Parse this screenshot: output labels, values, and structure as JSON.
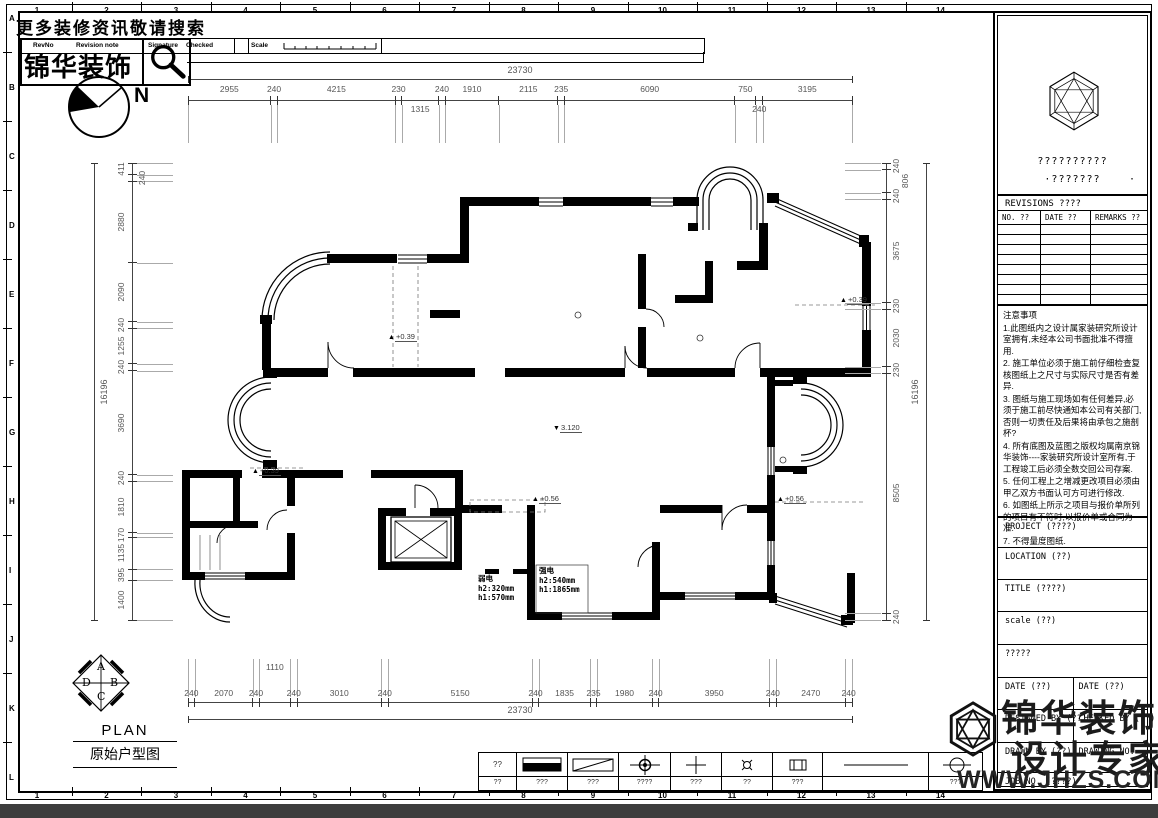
{
  "frame": {
    "grid_columns": [
      "1",
      "2",
      "3",
      "4",
      "5",
      "6",
      "7",
      "8",
      "9",
      "10",
      "11",
      "12",
      "13",
      "14"
    ],
    "grid_rows": [
      "A",
      "B",
      "C",
      "D",
      "E",
      "F",
      "G",
      "H",
      "I",
      "J",
      "K",
      "L"
    ]
  },
  "banner": {
    "search_text": "更多装修资讯敬请搜索",
    "logo_text": "锦华装饰"
  },
  "header_strip": {
    "rev_no": "RevNo",
    "revision_note": "Revision note",
    "signature": "Signature",
    "checked": "Checked",
    "scale": "Scale"
  },
  "compass": {
    "north": "N"
  },
  "dimensions": {
    "top": {
      "overall": "23730",
      "segments": [
        {
          "v": "2955"
        },
        {
          "v": "240"
        },
        {
          "v": "4215"
        },
        {
          "v": "230"
        },
        {
          "v": "1315",
          "row": 2
        },
        {
          "v": "240"
        },
        {
          "v": "1910"
        },
        {
          "v": "2115"
        },
        {
          "v": "235"
        },
        {
          "v": "6090"
        },
        {
          "v": "750"
        },
        {
          "v": "240",
          "row": 2
        },
        {
          "v": "3195"
        }
      ]
    },
    "bottom": {
      "overall": "23730",
      "segments": [
        {
          "v": "240"
        },
        {
          "v": "2070"
        },
        {
          "v": "240"
        },
        {
          "v": "1110",
          "row": 2
        },
        {
          "v": "240"
        },
        {
          "v": "3010"
        },
        {
          "v": "240"
        },
        {
          "v": "5150"
        },
        {
          "v": "240"
        },
        {
          "v": "1835"
        },
        {
          "v": "235"
        },
        {
          "v": "1980"
        },
        {
          "v": "240"
        },
        {
          "v": "3950"
        },
        {
          "v": "240"
        },
        {
          "v": "2470"
        },
        {
          "v": "240"
        }
      ]
    },
    "left": {
      "overall": "16196",
      "segments": [
        {
          "v": "411"
        },
        {
          "v": "240",
          "row": 2
        },
        {
          "v": "2880"
        },
        {
          "v": "2090"
        },
        {
          "v": "240"
        },
        {
          "v": "1255"
        },
        {
          "v": "240"
        },
        {
          "v": "3690"
        },
        {
          "v": "240"
        },
        {
          "v": "1810"
        },
        {
          "v": "170"
        },
        {
          "v": "1135"
        },
        {
          "v": "395"
        },
        {
          "v": "1400"
        }
      ]
    },
    "right": {
      "overall": "16196",
      "segments": [
        {
          "v": "240"
        },
        {
          "v": "806",
          "row": 2
        },
        {
          "v": "240"
        },
        {
          "v": "3675"
        },
        {
          "v": "230"
        },
        {
          "v": "2030"
        },
        {
          "v": "230"
        },
        {
          "v": "8505"
        },
        {
          "v": "240"
        }
      ]
    }
  },
  "plan": {
    "levels": [
      {
        "sym": "▲",
        "text": "+0.39"
      },
      {
        "sym": "▲",
        "text": "+0.39"
      },
      {
        "sym": "▲",
        "text": "+0.39"
      },
      {
        "sym": "▲",
        "text": "+0.56"
      },
      {
        "sym": "▲",
        "text": "+0.56"
      },
      {
        "sym": "▼",
        "text": "3.120"
      }
    ],
    "electrical": [
      {
        "name": "弱电",
        "h2": "h2:320mm",
        "h1": "h1:570mm"
      },
      {
        "name": "强电",
        "h2": "h2:540mm",
        "h1": "h1:1865mm"
      }
    ]
  },
  "plan_title": {
    "en": "PLAN",
    "cn": "原始户型图",
    "letters": [
      "A",
      "B",
      "C",
      "D"
    ]
  },
  "legend": {
    "first_symbol_text": "??",
    "items": [
      {
        "label": "??"
      },
      {
        "label": "???"
      },
      {
        "label": "???"
      },
      {
        "label": "????"
      },
      {
        "label": "???"
      },
      {
        "label": "??"
      },
      {
        "label": "???"
      },
      {
        "label": ""
      },
      {
        "label": "???"
      }
    ]
  },
  "title_block": {
    "company_line1": "??????????",
    "company_line2": "·???????",
    "company_dot": "·",
    "revisions_title": "REVISIONS ????",
    "rev_cols": [
      "NO. ??",
      "DATE ??",
      "REMARKS ??"
    ],
    "rev_empty_rows": 8,
    "notes_title": "注意事项",
    "notes": [
      "1.此图纸内之设计属家装研究所设计室拥有,未经本公司书面批准不得擅用.",
      "2. 施工单位必须于施工前仔细检查复核图纸上之尺寸与实际尺寸是否有差异.",
      "3. 图纸与施工现场如有任何差异,必须于施工前尽快通知本公司有关部门,否则一切责任及后果将由承包之施剖杯?",
      "4. 所有底图及蓝图之版权均属南京锦华装饰----家装研究所设计室所有,于工程竣工后必须全数交回公司存案.",
      "5. 任何工程上之增减更改项目必须由甲乙双方书面认可方可进行修改.",
      "6. 如图纸上所示之项目与报价单所列的项目有不符时,以报价单或合同为准.",
      "7. 不得量度图纸."
    ],
    "project": "PROJECT (????)",
    "location": "LOCATION (??)",
    "title": "TITLE (????)",
    "scale": "scale (??)",
    "extra": "?????",
    "date_left": "DATE (??)",
    "date_right": "DATE (??)",
    "designed_by": "DESIGNED BY (??)",
    "checked_by": "CHECKED BY (??)",
    "drawn_by": "DRAWN BY (??)",
    "drawing_no": "DRAWING NO.",
    "job_no": "JOB NO. (????)",
    "brand_cn1": "锦华装饰",
    "brand_cn2": "设计专家",
    "website": "WWW.JHZS.COM"
  }
}
